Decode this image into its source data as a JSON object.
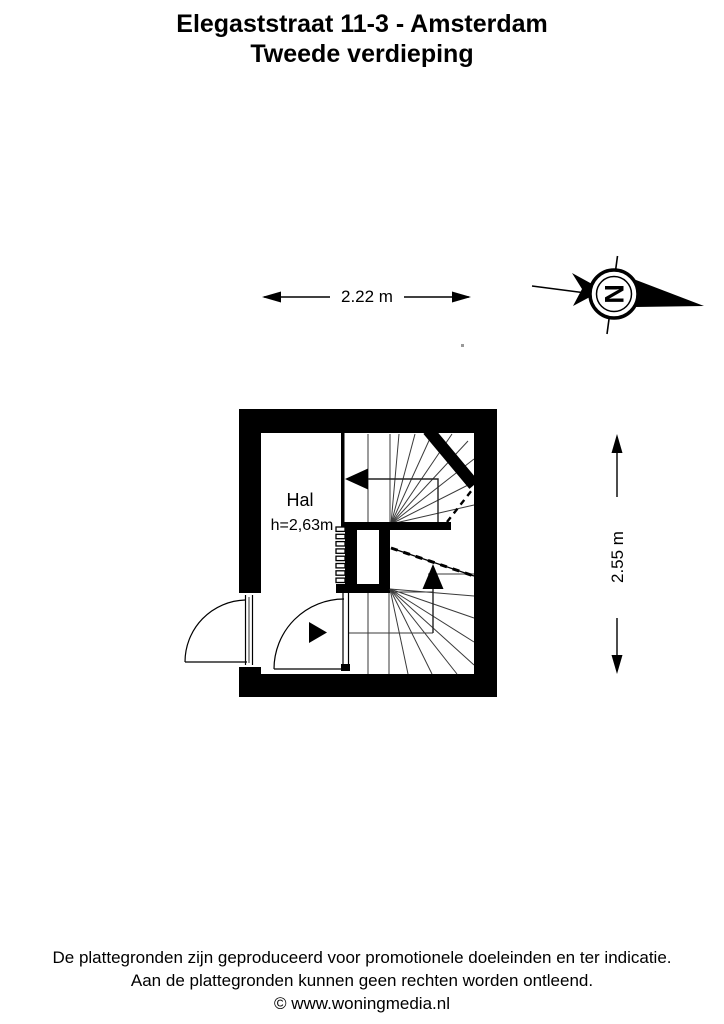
{
  "header": {
    "address": "Elegaststraat 11-3 - Amsterdam",
    "floor": "Tweede verdieping"
  },
  "floor_plan": {
    "room": {
      "name": "Hal",
      "ceiling_height": "h=2,63m"
    },
    "dimensions": {
      "width_label": "2.22 m",
      "depth_label": "2.55 m"
    },
    "compass": {
      "letter": "N",
      "orientation": "north-pointing-right"
    },
    "features": [
      "upper-winder-staircase-arrow-left",
      "lower-winder-staircase-arrow-up",
      "entrance-door-with-swing",
      "interior-door-with-swing",
      "entrance-direction-triangle",
      "radiator-comb-symbol"
    ]
  },
  "footer": {
    "line1": "De plattegronden zijn geproduceerd voor promotionele doeleinden en ter indicatie.",
    "line2": "Aan de plattegronden kunnen geen rechten worden ontleend.",
    "line3": "© www.woningmedia.nl"
  },
  "colors": {
    "ink": "#000000",
    "background": "#ffffff",
    "tread_line": "#3a3a3a"
  }
}
